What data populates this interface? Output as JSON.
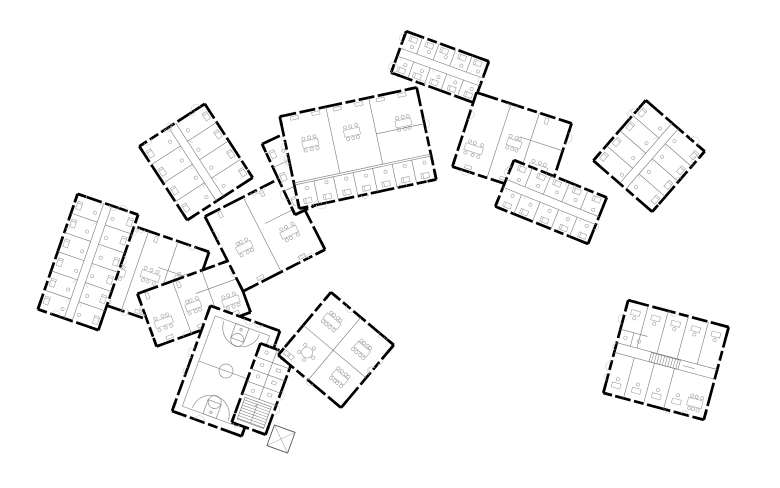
{
  "meta": {
    "aria_label": "Black-and-white architectural floor plan of a campus: a chain of angled residential wings with small bedrooms along corridors, common rooms and classrooms, a gymnasium with basketball court, a dining annex and a detached square office building at lower right",
    "canvas_width": 780,
    "canvas_height": 488
  },
  "style": {
    "background": "#ffffff",
    "wall_color": "#000000",
    "wall_width": 2.7,
    "wall_dash": [
      16,
      3.5,
      24,
      3.5,
      10,
      3.5
    ],
    "corner_mark": 9,
    "partition_color": "#777777",
    "partition_width": 0.6,
    "detail_color": "#9b9b9b",
    "detail_width": 0.55,
    "scallop_color": "#cccccc",
    "court_color": "#8f8f8f"
  },
  "buildings": [
    {
      "name": "commons-west",
      "type": "rooms",
      "cx": 150,
      "cy": 276,
      "w": 96,
      "h": 84,
      "rot": 19,
      "rooms": 3
    },
    {
      "name": "commons-southwest",
      "type": "rooms",
      "cx": 194,
      "cy": 303,
      "w": 100,
      "h": 56,
      "rot": -20,
      "rooms": 3
    },
    {
      "name": "dorm-wing-west",
      "type": "dorm",
      "cx": 88,
      "cy": 262,
      "w": 64,
      "h": 122,
      "rot": 19,
      "rooms": 6,
      "sides": 2
    },
    {
      "name": "dorm-wing-northwest",
      "type": "dorm",
      "cx": 196,
      "cy": 162,
      "w": 78,
      "h": 88,
      "rot": -33,
      "rooms": 4,
      "sides": 2
    },
    {
      "name": "commons-center",
      "type": "rooms",
      "cx": 265,
      "cy": 233,
      "w": 92,
      "h": 84,
      "rot": -27,
      "rooms": 2
    },
    {
      "name": "dorm-wing-center",
      "type": "dorm",
      "cx": 303,
      "cy": 168,
      "w": 54,
      "h": 78,
      "rot": -25,
      "rooms": 3,
      "sides": 2
    },
    {
      "name": "classroom-block-middle",
      "type": "mixed",
      "cx": 358,
      "cy": 148,
      "w": 140,
      "h": 94,
      "rot": -12,
      "rooms": 3,
      "cells": 7
    },
    {
      "name": "dorm-wing-north",
      "type": "dorm",
      "cx": 440,
      "cy": 67,
      "w": 88,
      "h": 44,
      "rot": 20,
      "rooms": 5,
      "sides": 2
    },
    {
      "name": "commons-north",
      "type": "rooms",
      "cx": 512,
      "cy": 145,
      "w": 100,
      "h": 78,
      "rot": 18,
      "rooms": 3
    },
    {
      "name": "dorm-wing-east",
      "type": "dorm",
      "cx": 551,
      "cy": 202,
      "w": 100,
      "h": 50,
      "rot": 22,
      "rooms": 5,
      "sides": 2
    },
    {
      "name": "dorm-block-east",
      "type": "dorm",
      "cx": 649,
      "cy": 156,
      "w": 78,
      "h": 80,
      "rot": 41,
      "rooms": 4,
      "sides": 2
    },
    {
      "name": "gym-hall",
      "type": "gym",
      "cx": 226,
      "cy": 371,
      "w": 74,
      "h": 112,
      "rot": 20
    },
    {
      "name": "gym-services",
      "type": "services",
      "cx": 263,
      "cy": 389,
      "w": 36,
      "h": 84,
      "rot": 20
    },
    {
      "name": "dining-annex-south",
      "type": "dining",
      "cx": 336,
      "cy": 350,
      "w": 82,
      "h": 82,
      "rot": 40
    },
    {
      "name": "office-block-south",
      "type": "office",
      "cx": 666,
      "cy": 360,
      "w": 104,
      "h": 96,
      "rot": 15
    },
    {
      "name": "garden-shed",
      "type": "shed",
      "cx": 281,
      "cy": 439,
      "w": 22,
      "h": 22,
      "rot": 20
    }
  ]
}
